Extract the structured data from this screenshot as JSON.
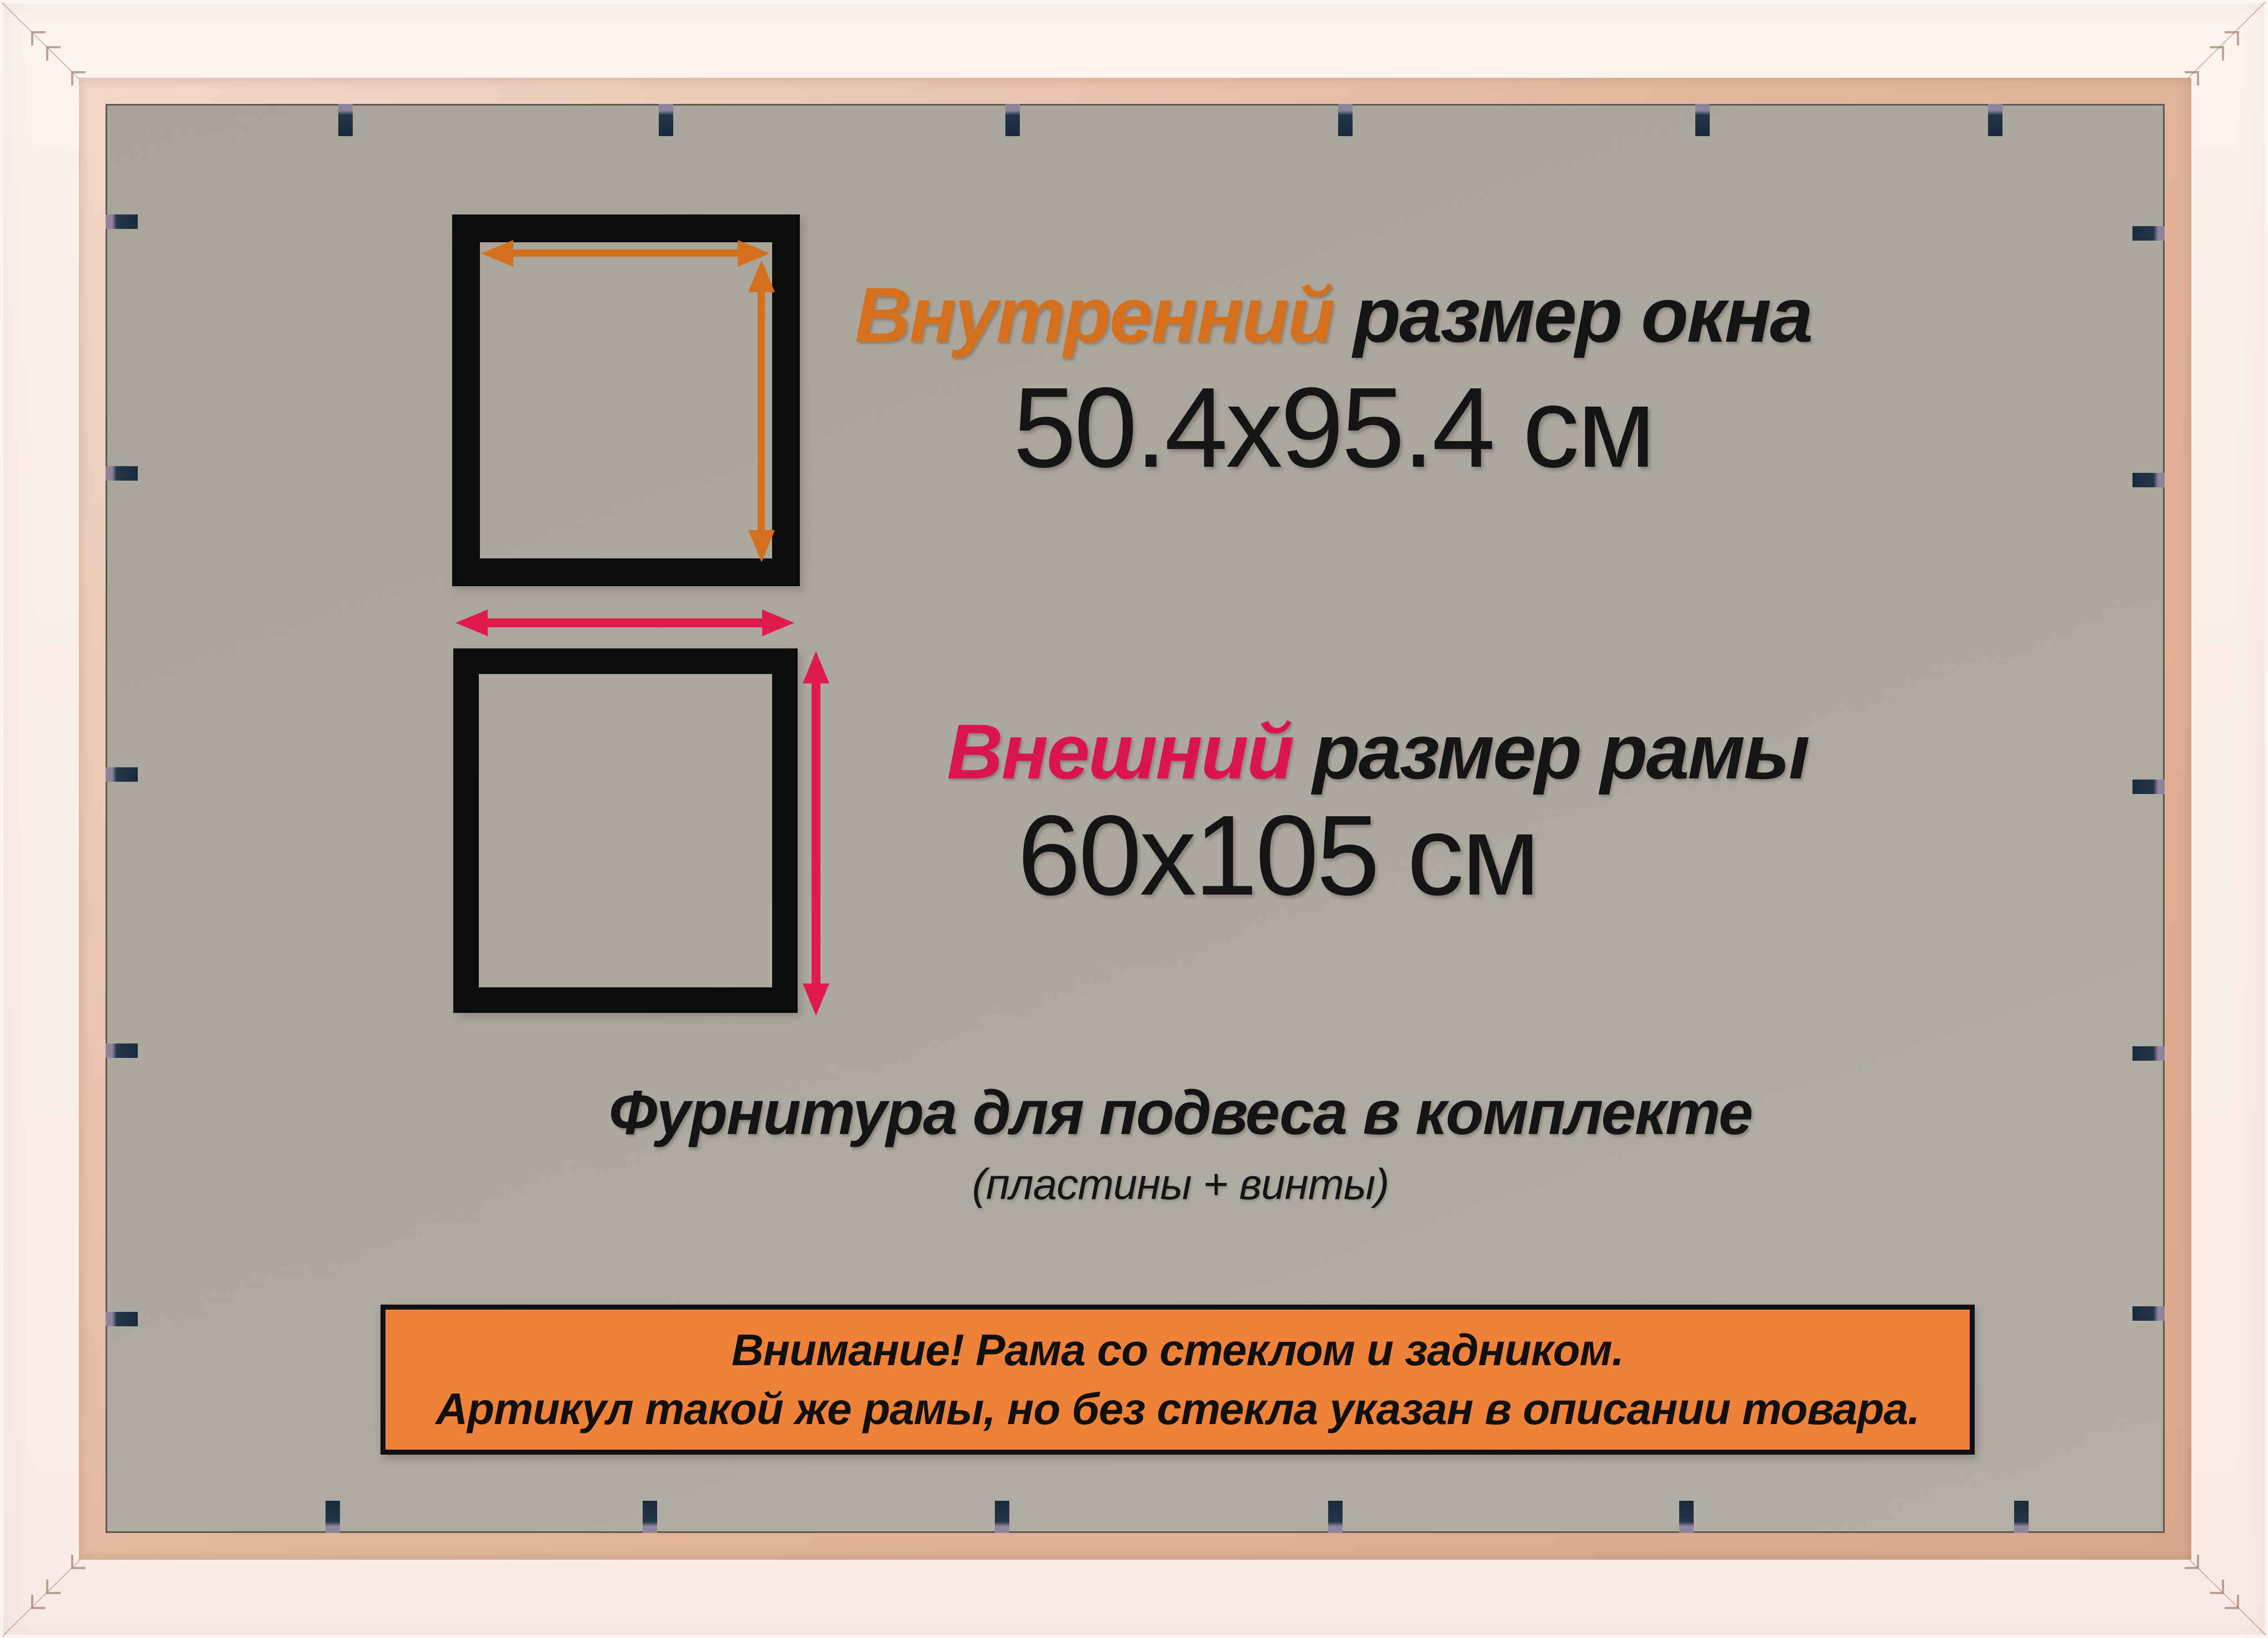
{
  "product_frame": {
    "frame_color": "#fbf0ea",
    "backing_color": "#aea99f",
    "clip_color": "#18293a",
    "clips": {
      "top_x": [
        622,
        1199,
        1823,
        2422,
        3065,
        3592
      ],
      "bottom_x": [
        599,
        1170,
        1804,
        2404,
        3036,
        3639
      ],
      "left_y": [
        399,
        852,
        1394,
        1891,
        2374
      ],
      "right_y": [
        420,
        864,
        1416,
        1896,
        2364
      ]
    },
    "vnail_offsets": [
      67,
      94,
      139
    ]
  },
  "inner_size": {
    "label_accent": "Внутренний",
    "label_rest": " размер окна",
    "value": "50.4x95.4 см",
    "accent_color": "#d4701c",
    "arrow_color": "#d4701c"
  },
  "outer_size": {
    "label_accent": "Внешний",
    "label_rest": " размер рамы",
    "value": "60x105 см",
    "accent_color": "#da1450",
    "arrow_color": "#e01a4e"
  },
  "hardware": {
    "line1": "Фурнитура для подвеса в комплекте",
    "line2": "(пластины + винты)"
  },
  "notice": {
    "line1": "Внимание! Рама со стеклом и задником.",
    "line2": "Артикул такой же рамы, но без стекла указан в описании товара.",
    "bg_color": "#ef8238"
  }
}
